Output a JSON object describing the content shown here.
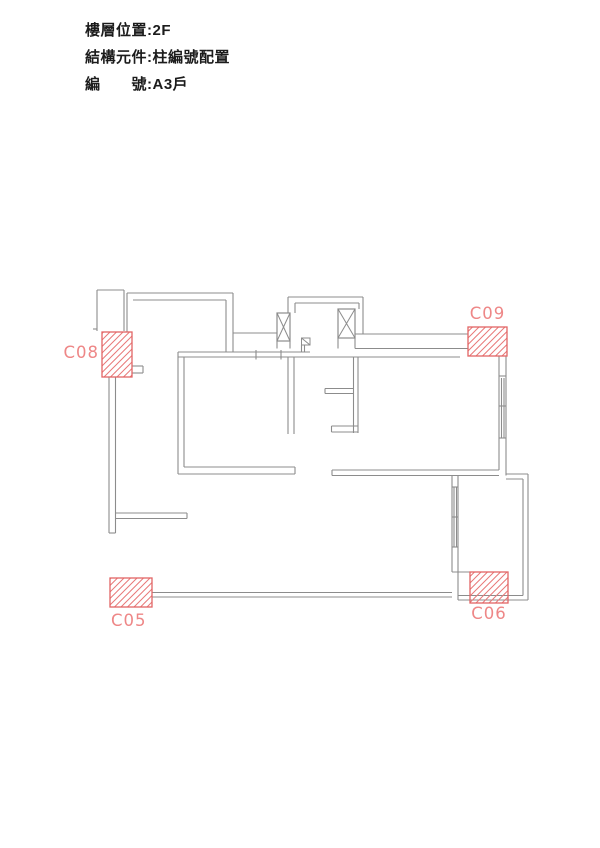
{
  "header": {
    "lines": [
      {
        "text": "樓層位置:2F"
      },
      {
        "text": "結構元件:柱編號配置"
      },
      {
        "text": "編　　號:A3戶"
      }
    ]
  },
  "plan": {
    "colors": {
      "wall": "#8c8c8c",
      "column_border": "#e26565",
      "column_hatch": "#e87878",
      "column_label": "#ee8787"
    },
    "columns": [
      {
        "id": "C05",
        "box": [
          110,
          578,
          42,
          29
        ],
        "label_pos": [
          111,
          626
        ],
        "anchor": "start"
      },
      {
        "id": "C06",
        "box": [
          470,
          572,
          38,
          31
        ],
        "label_pos": [
          489,
          619
        ],
        "anchor": "middle"
      },
      {
        "id": "C08",
        "box": [
          102,
          332,
          30,
          45
        ],
        "label_pos": [
          99,
          358
        ],
        "anchor": "end"
      },
      {
        "id": "C09",
        "box": [
          468,
          327,
          39,
          29
        ],
        "label_pos": [
          487.5,
          319
        ],
        "anchor": "middle"
      }
    ],
    "xboxes": [
      [
        277,
        313,
        13,
        28
      ],
      [
        338,
        309,
        17,
        29
      ]
    ],
    "diag_square": [
      301.5,
      338,
      8.5,
      7
    ],
    "walls": [
      [
        97,
        290,
        97,
        331
      ],
      [
        97,
        290,
        124,
        290
      ],
      [
        124,
        290,
        124,
        331
      ],
      [
        127,
        293,
        127,
        332
      ],
      [
        93,
        329,
        97,
        329
      ],
      [
        127,
        293,
        233,
        293
      ],
      [
        133,
        300,
        226,
        300
      ],
      [
        233,
        293,
        233,
        352
      ],
      [
        226,
        300,
        226,
        352
      ],
      [
        233,
        333,
        277,
        333
      ],
      [
        355,
        334,
        468,
        334
      ],
      [
        355,
        348.5,
        468,
        348.5
      ],
      [
        178,
        352,
        310,
        352
      ],
      [
        178,
        357,
        460,
        357
      ],
      [
        256,
        350,
        256,
        359.5
      ],
      [
        281,
        350,
        281,
        359.5
      ],
      [
        288,
        297,
        363,
        297
      ],
      [
        295,
        303,
        359,
        303
      ],
      [
        288,
        297,
        288,
        313
      ],
      [
        295,
        303,
        295,
        313
      ],
      [
        363,
        297,
        363,
        334
      ],
      [
        359,
        303,
        359,
        309
      ],
      [
        277,
        341,
        277,
        348.5
      ],
      [
        290,
        341,
        290,
        348.5
      ],
      [
        338,
        338,
        338,
        348.5
      ],
      [
        355,
        338,
        355,
        348.5
      ],
      [
        301.5,
        345,
        301.5,
        352
      ],
      [
        304.5,
        345,
        304.5,
        352
      ],
      [
        353.5,
        357,
        353.5,
        433
      ],
      [
        358,
        357,
        358,
        433
      ],
      [
        325,
        388.5,
        353.5,
        388.5
      ],
      [
        325,
        393.5,
        353.5,
        393.5
      ],
      [
        325,
        388.5,
        325,
        393.5
      ],
      [
        331.5,
        426,
        358,
        426
      ],
      [
        331.5,
        432,
        358,
        432
      ],
      [
        331.5,
        426,
        331.5,
        432
      ],
      [
        178,
        352,
        178,
        474
      ],
      [
        184,
        357,
        184,
        467
      ],
      [
        288,
        357,
        288,
        434
      ],
      [
        294,
        357,
        294,
        434
      ],
      [
        184,
        467,
        295,
        467
      ],
      [
        178,
        474,
        295,
        474
      ],
      [
        295,
        467,
        295,
        474
      ],
      [
        332,
        470,
        499,
        470
      ],
      [
        332,
        475.5,
        499,
        475.5
      ],
      [
        332,
        470,
        332,
        475.5
      ],
      [
        499,
        356,
        499,
        470
      ],
      [
        506,
        356,
        506,
        475.5
      ],
      [
        501.5,
        378,
        501.5,
        438
      ],
      [
        504,
        378,
        504,
        438
      ],
      [
        499,
        376,
        506,
        376
      ],
      [
        499,
        406,
        506,
        406
      ],
      [
        499,
        438,
        506,
        438
      ],
      [
        452,
        475.5,
        452,
        572
      ],
      [
        458,
        475.5,
        458,
        572
      ],
      [
        454,
        487,
        454,
        547
      ],
      [
        456.5,
        487,
        456.5,
        547
      ],
      [
        452,
        487,
        458,
        487
      ],
      [
        452,
        517,
        458,
        517
      ],
      [
        452,
        547,
        458,
        547
      ],
      [
        452,
        572,
        470,
        572
      ],
      [
        506,
        474,
        528,
        474
      ],
      [
        528,
        474,
        528,
        600
      ],
      [
        523,
        479,
        523,
        595.5
      ],
      [
        506,
        479,
        523,
        479
      ],
      [
        458,
        572,
        458,
        600
      ],
      [
        458,
        600,
        528,
        600
      ],
      [
        458,
        595.5,
        523,
        595.5
      ],
      [
        152,
        592.5,
        452,
        592.5
      ],
      [
        152,
        597,
        452,
        597
      ],
      [
        109,
        377,
        109,
        533
      ],
      [
        115.5,
        377,
        115.5,
        533
      ],
      [
        109,
        533,
        115.5,
        533
      ],
      [
        115.5,
        513,
        187,
        513
      ],
      [
        115.5,
        518.5,
        187,
        518.5
      ],
      [
        187,
        513,
        187,
        518.5
      ],
      [
        132,
        366,
        143,
        366
      ],
      [
        143,
        366,
        143,
        373
      ],
      [
        132,
        373,
        143,
        373
      ]
    ]
  }
}
